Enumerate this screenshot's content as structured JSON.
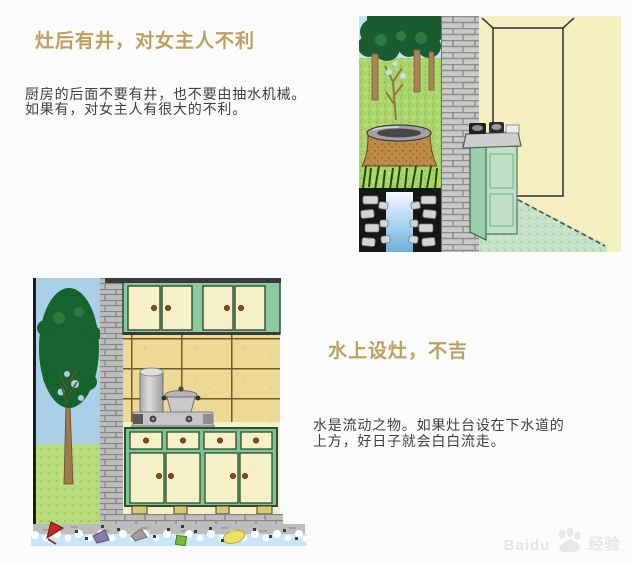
{
  "page": {
    "width_px": 631,
    "height_px": 563,
    "background": "#fbfbfb"
  },
  "colors": {
    "title_accent": "#bda05f",
    "body_text": "#3f3f3f",
    "watermark_gray": "#e4e4e4"
  },
  "sections": [
    {
      "title": "灶后有井，对女主人不利",
      "body_lines": [
        "厨房的后面不要有井，也不要由抽水机械。",
        "如果有，对女主人有很大的不利。"
      ],
      "illustration": "kitchen-stove-with-well-behind-wall"
    },
    {
      "title": "水上设灶，不吉",
      "body_lines": [
        "水是流动之物。如果灶台设在下水道的",
        "上方，好日子就会白白流走。"
      ],
      "illustration": "kitchen-cabinets-above-drain-waterway"
    }
  ],
  "watermark": {
    "text_left": "Baidu",
    "text_right": "经验",
    "icon": "baidu-paw-icon"
  }
}
